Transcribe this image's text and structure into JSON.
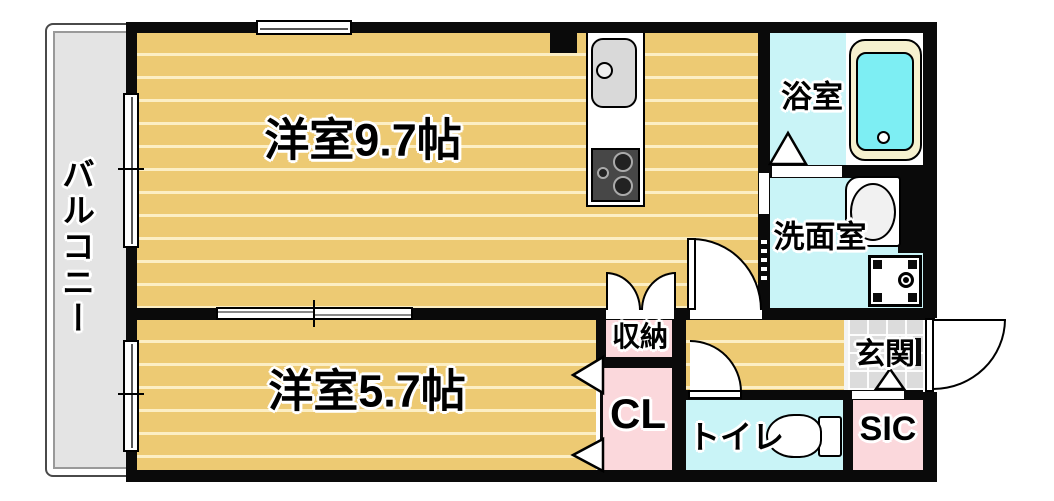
{
  "labels": {
    "balcony": "バルコニー",
    "room_large": "洋室9.7帖",
    "room_small": "洋室5.7帖",
    "bath": "浴室",
    "washroom": "洗面室",
    "storage": "収納",
    "closet": "CL",
    "toilet": "トイレ",
    "entrance": "玄関",
    "shoe_closet": "SIC"
  },
  "colors": {
    "wood_floor": "#edca73",
    "wood_stripe": "#f7e2a1",
    "wet_area_floor": "#c9f4f7",
    "bathtub_water": "#7deef3",
    "bathtub_rim": "#f6f1cf",
    "closet_pink": "#fbd8dc",
    "entrance_tile": "#dcdcdc",
    "balcony_gray": "#e4e4e4",
    "wall": "#0a0a0a"
  },
  "fixtures": [
    "kitchen-sink",
    "gas-stove",
    "bathtub",
    "washbasin",
    "washing-machine-pan",
    "toilet-bowl"
  ]
}
